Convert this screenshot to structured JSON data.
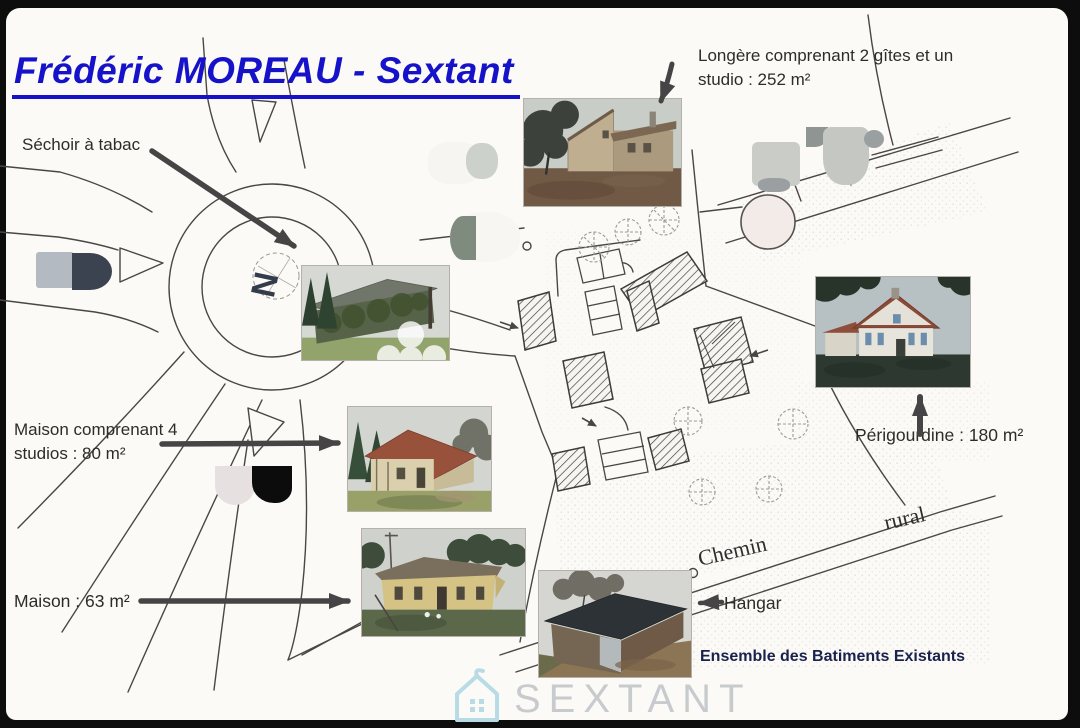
{
  "title": "Frédéric MOREAU - Sextant",
  "labels": {
    "sechoir": "Séchoir à tabac",
    "longere_line1": "Longère comprenant 2 gîtes et un",
    "longere_line2": "studio : 252 m²",
    "maison_studios_line1": "Maison comprenant 4",
    "maison_studios_line2": "studios : 80 m²",
    "perigourdine": "Périgourdine : 180 m²",
    "maison": "Maison : 63 m²",
    "hangar": "Hangar",
    "ensemble": "Ensemble des Batiments Existants"
  },
  "map": {
    "road_label_chemin": "Chemin",
    "road_label_rural": "rural",
    "compass_letter": "N"
  },
  "logo": {
    "wordmark": "SEXTANT",
    "icon": "house-icon"
  },
  "photos": [
    {
      "id": "longere",
      "caption_ref": "Longère 2 gîtes + studio 252 m²"
    },
    {
      "id": "sechoir",
      "caption_ref": "Séchoir à tabac"
    },
    {
      "id": "perigourdine",
      "caption_ref": "Périgourdine 180 m²"
    },
    {
      "id": "maison-4-studios",
      "caption_ref": "Maison 4 studios 80 m²"
    },
    {
      "id": "maison-63",
      "caption_ref": "Maison 63 m²"
    },
    {
      "id": "hangar",
      "caption_ref": "Hangar"
    }
  ],
  "colors": {
    "title_blue": "#1512c9",
    "text_dark": "#2e2c29",
    "caption_navy": "#19224d",
    "arrow_gray": "#454545",
    "map_line": "#4a4743",
    "logo_teal": "#b7dce6",
    "logo_gray": "#c7cbce"
  }
}
